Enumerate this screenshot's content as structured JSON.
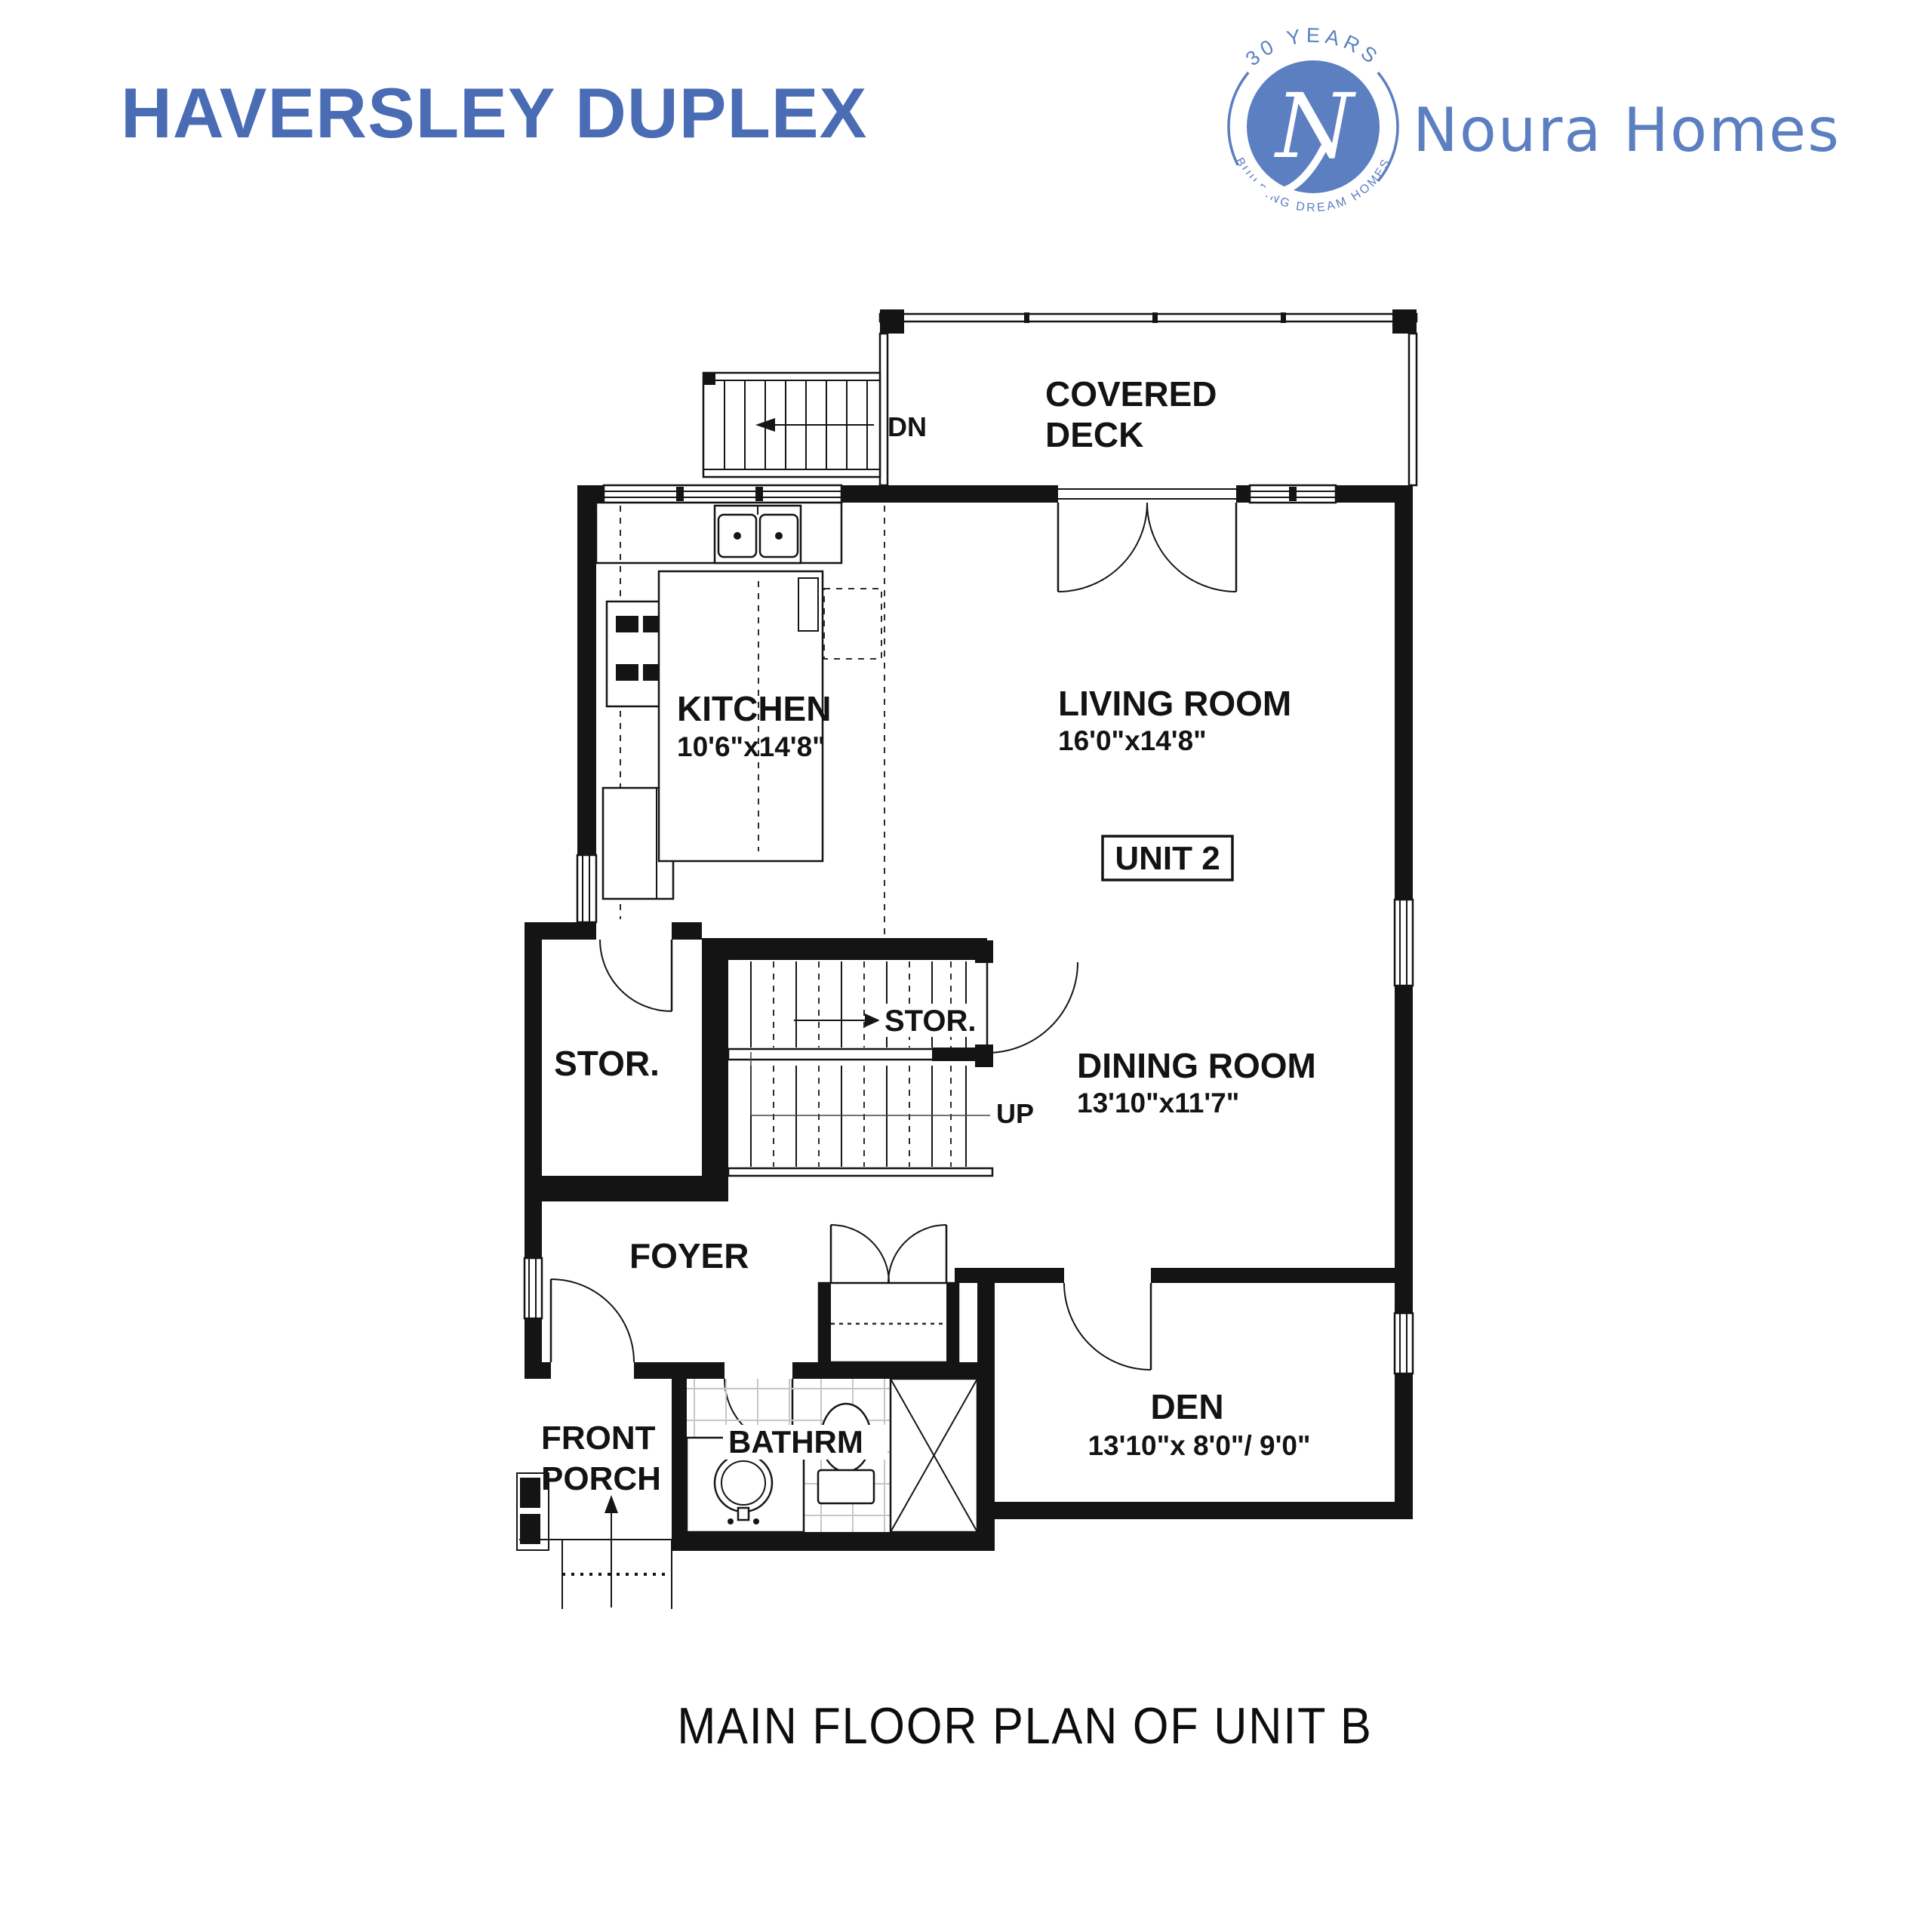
{
  "header": {
    "title": "HAVERSLEY DUPLEX"
  },
  "logo": {
    "arc_top": "30 YEARS",
    "arc_bottom": "BUILDING DREAM HOMES",
    "monogram": "N",
    "brand": "Noura Homes"
  },
  "colors": {
    "title_blue": "#4a6cb5",
    "logo_blue": "#5c7fc1",
    "line_black": "#141414"
  },
  "floorplan": {
    "unit_badge": "UNIT 2",
    "stair_annotations": {
      "down": "DN",
      "up": "UP"
    },
    "rooms": {
      "covered_deck": {
        "line1": "COVERED",
        "line2": "DECK"
      },
      "kitchen": {
        "label": "KITCHEN",
        "dims": "10'6\"x14'8\""
      },
      "living_room": {
        "label": "LIVING ROOM",
        "dims": "16'0\"x14'8\""
      },
      "dining_room": {
        "label": "DINING ROOM",
        "dims": "13'10\"x11'7\""
      },
      "den": {
        "label": "DEN",
        "dims": "13'10\"x 8'0\"/ 9'0\""
      },
      "storage": {
        "label": "STOR."
      },
      "stair_storage": {
        "label": "STOR."
      },
      "foyer": {
        "label": "FOYER"
      },
      "front_porch": {
        "line1": "FRONT",
        "line2": "PORCH"
      },
      "bathroom": {
        "label": "BATHRM"
      }
    }
  },
  "caption": "MAIN FLOOR PLAN OF UNIT B"
}
